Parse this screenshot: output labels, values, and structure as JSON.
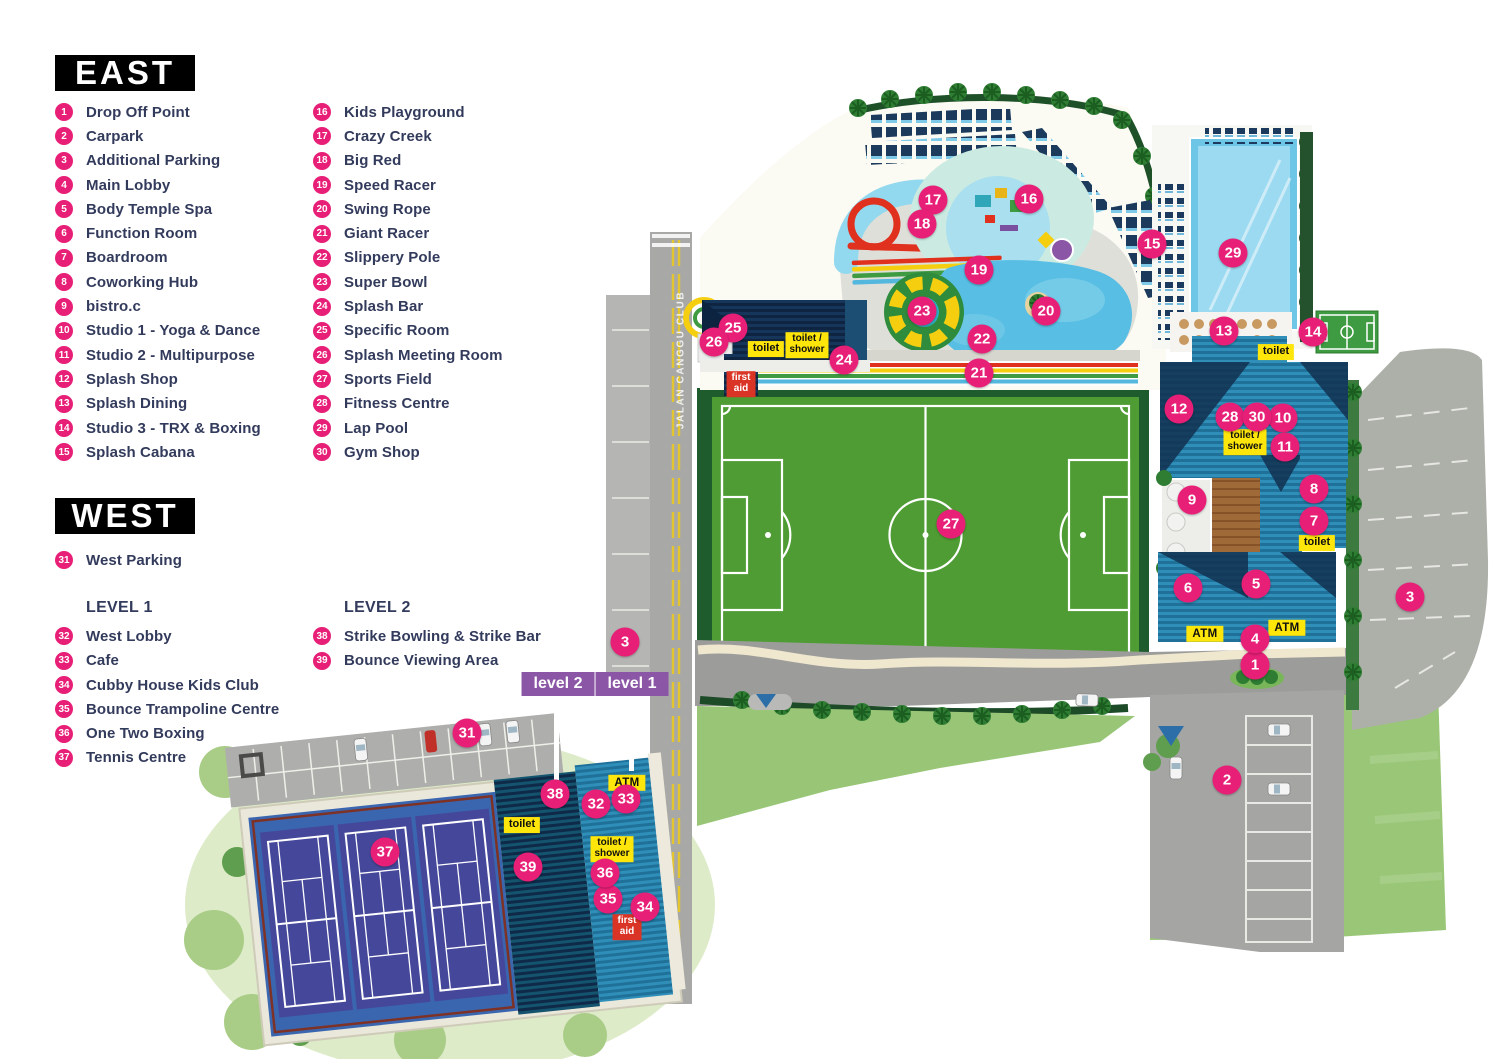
{
  "legend": {
    "east": {
      "title": "EAST",
      "items_col1": [
        {
          "num": "1",
          "label": "Drop Off Point"
        },
        {
          "num": "2",
          "label": "Carpark"
        },
        {
          "num": "3",
          "label": "Additional Parking"
        },
        {
          "num": "4",
          "label": "Main Lobby"
        },
        {
          "num": "5",
          "label": "Body Temple Spa"
        },
        {
          "num": "6",
          "label": "Function Room"
        },
        {
          "num": "7",
          "label": "Boardroom"
        },
        {
          "num": "8",
          "label": "Coworking Hub"
        },
        {
          "num": "9",
          "label": "bistro.c"
        },
        {
          "num": "10",
          "label": "Studio 1 - Yoga & Dance"
        },
        {
          "num": "11",
          "label": "Studio 2 - Multipurpose"
        },
        {
          "num": "12",
          "label": "Splash Shop"
        },
        {
          "num": "13",
          "label": "Splash Dining"
        },
        {
          "num": "14",
          "label": "Studio 3 - TRX & Boxing"
        },
        {
          "num": "15",
          "label": "Splash Cabana"
        }
      ],
      "items_col2": [
        {
          "num": "16",
          "label": "Kids Playground"
        },
        {
          "num": "17",
          "label": "Crazy Creek"
        },
        {
          "num": "18",
          "label": "Big Red"
        },
        {
          "num": "19",
          "label": "Speed Racer"
        },
        {
          "num": "20",
          "label": "Swing Rope"
        },
        {
          "num": "21",
          "label": "Giant Racer"
        },
        {
          "num": "22",
          "label": "Slippery Pole"
        },
        {
          "num": "23",
          "label": "Super Bowl"
        },
        {
          "num": "24",
          "label": "Splash Bar"
        },
        {
          "num": "25",
          "label": "Specific Room"
        },
        {
          "num": "26",
          "label": "Splash Meeting Room"
        },
        {
          "num": "27",
          "label": "Sports Field"
        },
        {
          "num": "28",
          "label": "Fitness Centre"
        },
        {
          "num": "29",
          "label": "Lap Pool"
        },
        {
          "num": "30",
          "label": "Gym Shop"
        }
      ]
    },
    "west": {
      "title": "WEST",
      "items": [
        {
          "num": "31",
          "label": "West Parking"
        }
      ],
      "level1": {
        "title": "LEVEL 1",
        "items": [
          {
            "num": "32",
            "label": "West Lobby"
          },
          {
            "num": "33",
            "label": "Cafe"
          },
          {
            "num": "34",
            "label": "Cubby House Kids Club"
          },
          {
            "num": "35",
            "label": "Bounce Trampoline Centre"
          },
          {
            "num": "36",
            "label": "One Two Boxing"
          },
          {
            "num": "37",
            "label": "Tennis Centre"
          }
        ]
      },
      "level2": {
        "title": "LEVEL 2",
        "items": [
          {
            "num": "38",
            "label": "Strike Bowling & Strike Bar"
          },
          {
            "num": "39",
            "label": "Bounce Viewing Area"
          }
        ]
      }
    }
  },
  "map": {
    "road_label": "JALAN CANGGU CLUB",
    "level_labels": [
      {
        "text": "level 2",
        "x": 558,
        "y": 684
      },
      {
        "text": "level 1",
        "x": 632,
        "y": 684
      }
    ],
    "markers": [
      {
        "num": "1",
        "x": 1255,
        "y": 665
      },
      {
        "num": "2",
        "x": 1227,
        "y": 780
      },
      {
        "num": "3",
        "x": 1410,
        "y": 597
      },
      {
        "num": "3",
        "x": 625,
        "y": 642
      },
      {
        "num": "4",
        "x": 1255,
        "y": 639
      },
      {
        "num": "5",
        "x": 1256,
        "y": 584
      },
      {
        "num": "6",
        "x": 1188,
        "y": 588
      },
      {
        "num": "7",
        "x": 1314,
        "y": 521
      },
      {
        "num": "8",
        "x": 1314,
        "y": 489
      },
      {
        "num": "9",
        "x": 1192,
        "y": 500
      },
      {
        "num": "10",
        "x": 1283,
        "y": 418
      },
      {
        "num": "11",
        "x": 1285,
        "y": 447
      },
      {
        "num": "12",
        "x": 1179,
        "y": 409
      },
      {
        "num": "13",
        "x": 1224,
        "y": 331
      },
      {
        "num": "14",
        "x": 1313,
        "y": 332
      },
      {
        "num": "15",
        "x": 1152,
        "y": 244
      },
      {
        "num": "16",
        "x": 1029,
        "y": 199
      },
      {
        "num": "17",
        "x": 933,
        "y": 200
      },
      {
        "num": "18",
        "x": 922,
        "y": 224
      },
      {
        "num": "19",
        "x": 979,
        "y": 270
      },
      {
        "num": "20",
        "x": 1046,
        "y": 311
      },
      {
        "num": "21",
        "x": 979,
        "y": 373
      },
      {
        "num": "22",
        "x": 982,
        "y": 339
      },
      {
        "num": "23",
        "x": 922,
        "y": 311
      },
      {
        "num": "24",
        "x": 844,
        "y": 360
      },
      {
        "num": "25",
        "x": 733,
        "y": 328
      },
      {
        "num": "26",
        "x": 714,
        "y": 342
      },
      {
        "num": "27",
        "x": 951,
        "y": 524
      },
      {
        "num": "28",
        "x": 1230,
        "y": 417
      },
      {
        "num": "29",
        "x": 1233,
        "y": 253
      },
      {
        "num": "30",
        "x": 1257,
        "y": 417
      },
      {
        "num": "31",
        "x": 467,
        "y": 733
      },
      {
        "num": "32",
        "x": 596,
        "y": 804
      },
      {
        "num": "33",
        "x": 626,
        "y": 799
      },
      {
        "num": "34",
        "x": 645,
        "y": 907
      },
      {
        "num": "35",
        "x": 608,
        "y": 899
      },
      {
        "num": "36",
        "x": 605,
        "y": 873
      },
      {
        "num": "37",
        "x": 385,
        "y": 852
      },
      {
        "num": "38",
        "x": 555,
        "y": 794
      },
      {
        "num": "39",
        "x": 528,
        "y": 867
      }
    ],
    "amenities": [
      {
        "type": "toilet",
        "text": "toilet",
        "x": 766,
        "y": 349
      },
      {
        "type": "toilet-shower",
        "text": "toilet /\nshower",
        "x": 807,
        "y": 345
      },
      {
        "type": "first-aid",
        "text": "first\naid",
        "x": 741,
        "y": 384
      },
      {
        "type": "toilet",
        "text": "toilet",
        "x": 1276,
        "y": 352
      },
      {
        "type": "toilet-shower",
        "text": "toilet /\nshower",
        "x": 1245,
        "y": 442
      },
      {
        "type": "toilet",
        "text": "toilet",
        "x": 1317,
        "y": 543
      },
      {
        "type": "atm",
        "text": "ATM",
        "x": 1205,
        "y": 634
      },
      {
        "type": "atm",
        "text": "ATM",
        "x": 1287,
        "y": 628
      },
      {
        "type": "atm",
        "text": "ATM",
        "x": 627,
        "y": 783
      },
      {
        "type": "toilet",
        "text": "toilet",
        "x": 522,
        "y": 825
      },
      {
        "type": "toilet-shower",
        "text": "toilet /\nshower",
        "x": 612,
        "y": 849
      },
      {
        "type": "first-aid",
        "text": "first\naid",
        "x": 627,
        "y": 927
      }
    ],
    "colors": {
      "marker_pink": "#E81F77",
      "label_yellow": "#FFE60A",
      "label_red": "#D93425",
      "label_purple": "#8A56A5",
      "legend_text": "#333B5C"
    }
  }
}
